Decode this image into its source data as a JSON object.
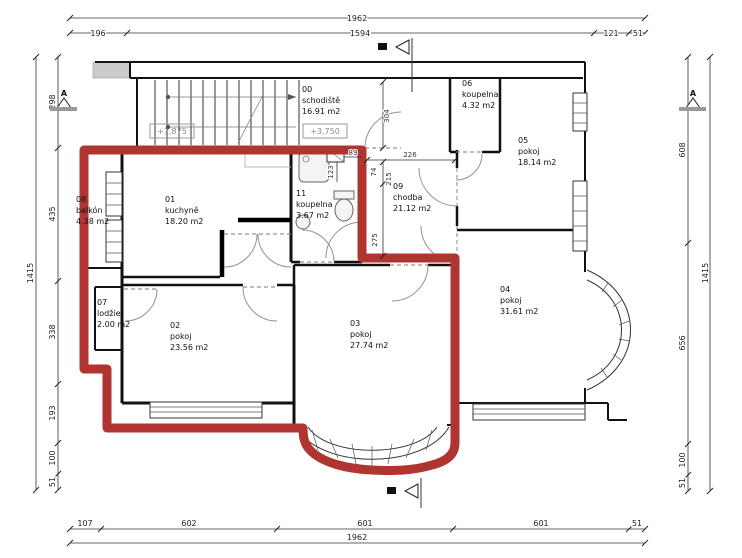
{
  "rooms": [
    {
      "id": "00",
      "name": "schodiště",
      "area": "16.91 m2"
    },
    {
      "id": "01",
      "name": "kuchyně",
      "area": "18.20 m2"
    },
    {
      "id": "02",
      "name": "pokoj",
      "area": "23.56 m2"
    },
    {
      "id": "03",
      "name": "pokoj",
      "area": "27.74 m2"
    },
    {
      "id": "04",
      "name": "pokoj",
      "area": "31.61 m2"
    },
    {
      "id": "05",
      "name": "pokoj",
      "area": "18.14 m2"
    },
    {
      "id": "06",
      "name": "koupelna",
      "area": "4.32 m2"
    },
    {
      "id": "07",
      "name": "lodžie",
      "area": "2.00 m2"
    },
    {
      "id": "08",
      "name": "balkón",
      "area": "4.38 m2"
    },
    {
      "id": "09",
      "name": "chodba",
      "area": "21.12 m2"
    },
    {
      "id": "11",
      "name": "koupelna",
      "area": "3.67 m2"
    }
  ],
  "elevations": {
    "lower": "+1,875",
    "upper": "+3,750"
  },
  "dims": {
    "top": {
      "overall": "1962",
      "seg": [
        "196",
        "1594",
        "121",
        "51"
      ]
    },
    "bottom": {
      "overall": "1962",
      "seg": [
        "107",
        "602",
        "601",
        "601",
        "51"
      ]
    },
    "left": {
      "overall": "1415",
      "seg": [
        "298",
        "435",
        "338",
        "193",
        "100",
        "51"
      ]
    },
    "right": {
      "overall": "1415",
      "seg": [
        "608",
        "656",
        "100",
        "51"
      ]
    },
    "interior": {
      "i304": "304",
      "i226": "226",
      "i74": "74",
      "i215": "215",
      "i275": "275",
      "i89": "89",
      "i123": "123"
    }
  },
  "markers": {
    "a": "A"
  },
  "colors": {
    "boundary": "#b0342f",
    "walls": "#111111",
    "dim_text": "#222222",
    "muted": "#8a8a8a"
  }
}
